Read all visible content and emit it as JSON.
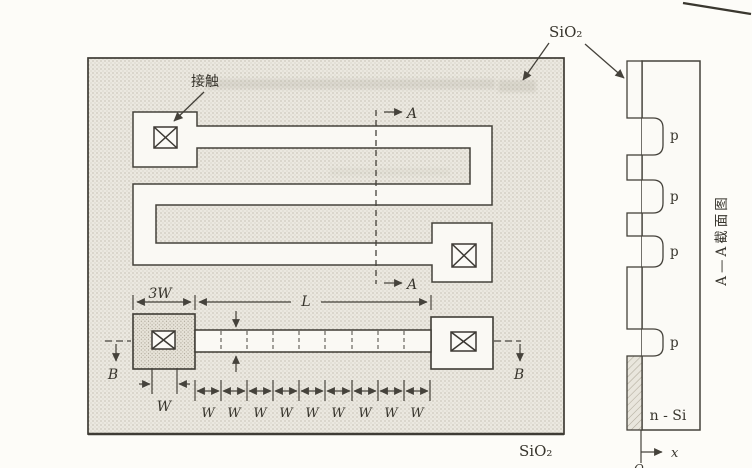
{
  "labels": {
    "contact": "接触",
    "sio2": "SiO₂",
    "section_a": "A",
    "section_b": "B"
  },
  "dims": {
    "pad3w": "3W",
    "length": "L",
    "contact_w": "W",
    "squares": [
      "W",
      "W",
      "W",
      "W",
      "W",
      "W",
      "W",
      "W",
      "W"
    ]
  },
  "xsec": {
    "p": [
      "p",
      "p",
      "p",
      "p"
    ],
    "substrate": "n - Si",
    "axis_x": "x",
    "origin": "O",
    "title": "A—A截面图"
  },
  "colors": {
    "ink": "#45423b",
    "shade_bg": "#ebe8e0",
    "white_fill": "#faf9f4"
  }
}
